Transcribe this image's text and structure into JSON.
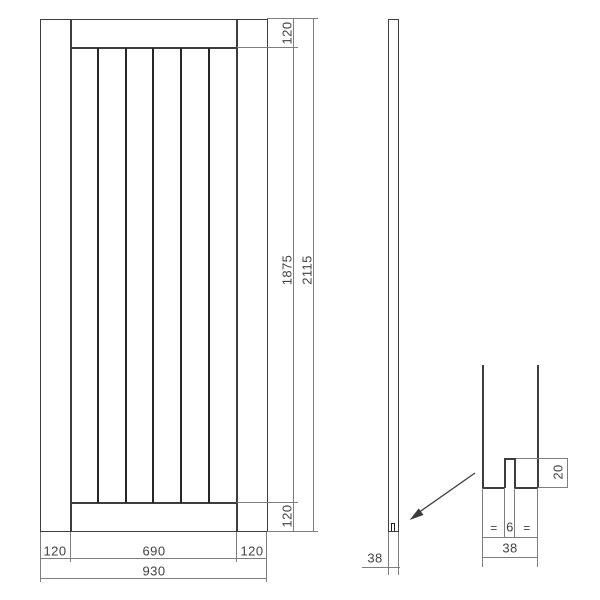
{
  "drawing": {
    "front_view": {
      "top_rail_height": "120",
      "panel_height": "1875",
      "total_height": "2115",
      "bottom_rail_height": "120",
      "left_stile_width": "120",
      "panel_width": "690",
      "right_stile_width": "120",
      "total_width": "930"
    },
    "side_view": {
      "thickness": "38"
    },
    "detail_view": {
      "groove_depth": "20",
      "equal_left": "=",
      "groove_width": "6",
      "equal_right": "=",
      "width": "38"
    },
    "line_colors": {
      "object": "#3d3d3d",
      "plank_joint": "#262626",
      "dimension": "#7d7d7d"
    }
  }
}
